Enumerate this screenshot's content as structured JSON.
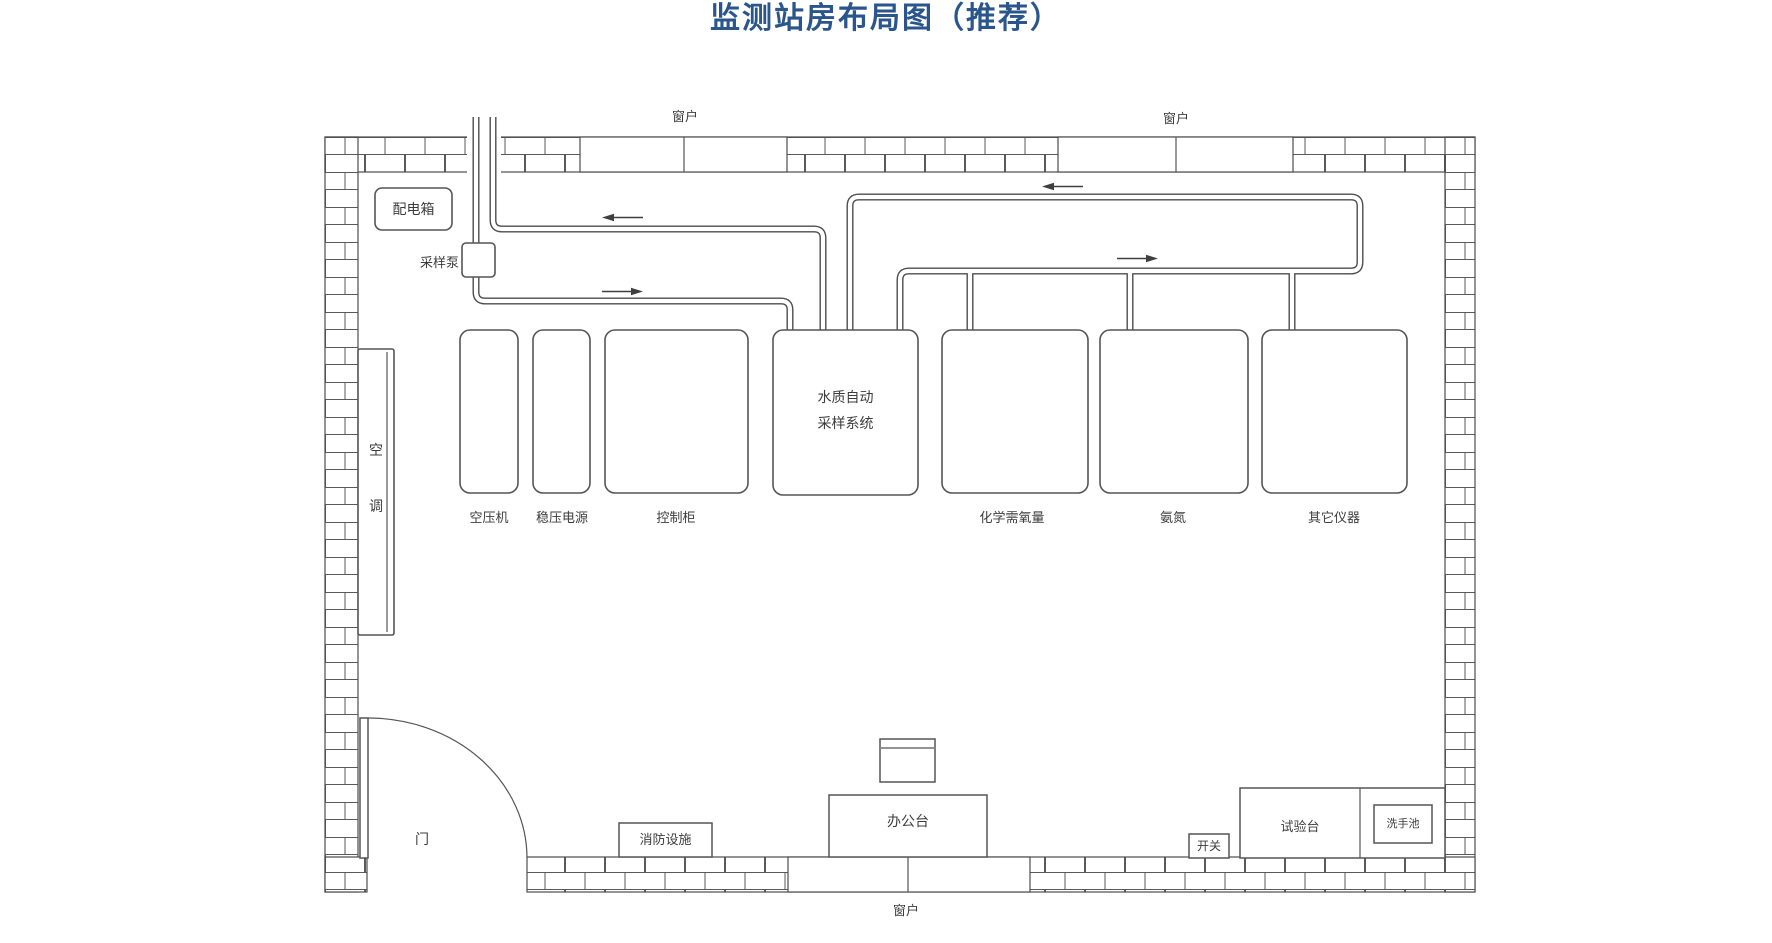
{
  "title": "监测站房布局图（推荐）",
  "colors": {
    "title_blue": "#2a568c",
    "line_gray": "#4d4d4d"
  },
  "room": {
    "window_top_left": "窗户",
    "window_top_right": "窗户",
    "window_bottom": "窗户",
    "door": "门"
  },
  "equipment": {
    "distribution_box": "配电箱",
    "sampling_pump": "采样泵",
    "air_conditioner": "空\n调",
    "air_compressor": "空压机",
    "voltage_stabilizer": "稳压电源",
    "control_cabinet": "控制柜",
    "water_sampling_system": "水质自动\n采样系统",
    "cod_analyzer": "化学需氧量",
    "ammonia_analyzer": "氨氮",
    "other_instruments": "其它仪器"
  },
  "furniture": {
    "fire_equipment": "消防设施",
    "office_desk": "办公台",
    "switch": "开关",
    "test_bench": "试验台",
    "sink": "洗手池"
  }
}
